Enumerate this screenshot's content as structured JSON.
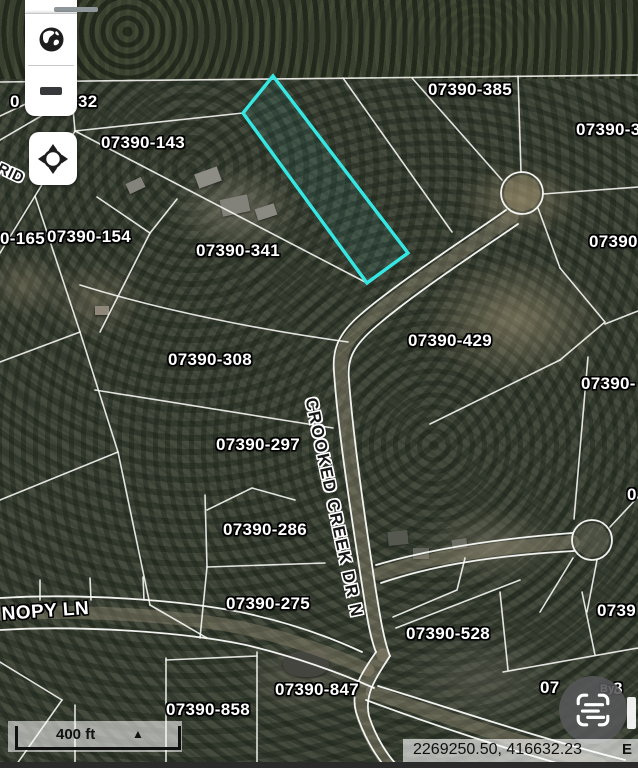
{
  "map": {
    "selected_parcel_color": "#35e7e3",
    "parcel_labels": [
      {
        "text": "07390-385",
        "x": 428,
        "y": 80
      },
      {
        "text": "07390-3",
        "x": 576,
        "y": 120
      },
      {
        "text": "07390-143",
        "x": 101,
        "y": 133
      },
      {
        "text": "0",
        "x": 10,
        "y": 92
      },
      {
        "text": "32",
        "x": 78,
        "y": 92
      },
      {
        "text": "0-165",
        "x": 0,
        "y": 229
      },
      {
        "text": "07390-154",
        "x": 47,
        "y": 227
      },
      {
        "text": "07390-341",
        "x": 196,
        "y": 241
      },
      {
        "text": "07390",
        "x": 589,
        "y": 232
      },
      {
        "text": "07390-308",
        "x": 168,
        "y": 350
      },
      {
        "text": "07390-429",
        "x": 408,
        "y": 331
      },
      {
        "text": "07390-",
        "x": 581,
        "y": 374
      },
      {
        "text": "07390-297",
        "x": 216,
        "y": 435
      },
      {
        "text": "0",
        "x": 627,
        "y": 485
      },
      {
        "text": "07390-286",
        "x": 223,
        "y": 520
      },
      {
        "text": "07390-275",
        "x": 226,
        "y": 594
      },
      {
        "text": "07390-528",
        "x": 406,
        "y": 624
      },
      {
        "text": "0739",
        "x": 597,
        "y": 601
      },
      {
        "text": "07390-847",
        "x": 275,
        "y": 680
      },
      {
        "text": "07390-858",
        "x": 166,
        "y": 700
      },
      {
        "text": "07",
        "x": 540,
        "y": 678
      },
      {
        "text": "8",
        "x": 613,
        "y": 679
      },
      {
        "text": "By",
        "x": 600,
        "y": 683,
        "size": 11
      }
    ],
    "road_labels": [
      {
        "text": "CROOKED CREEK DR N",
        "x": 320,
        "y": 396,
        "rot": 78,
        "style": "dark",
        "size": 17,
        "ls": 1.5
      },
      {
        "text": "NOPY LN",
        "x": 1,
        "y": 604,
        "rot": -4,
        "style": "light",
        "size": 19,
        "ls": 0.5
      },
      {
        "text": "RID",
        "x": 2,
        "y": 160,
        "rot": 25,
        "style": "dark",
        "size": 15,
        "ls": 0.5
      }
    ]
  },
  "toolbar": {
    "buttons": [
      {
        "icon": "globe-icon",
        "name": "basemap"
      },
      {
        "icon": "minus-icon",
        "name": "zoom-out"
      },
      {
        "icon": "crosshair-icon",
        "name": "locate"
      }
    ]
  },
  "scale_bar": {
    "label": "400 ft",
    "toggle_glyph": "▲"
  },
  "status_bar": {
    "coordinates": "2269250.50, 416632.23",
    "edge_glyph": "E"
  },
  "floating_button": {
    "icon": "scan-text-icon"
  }
}
